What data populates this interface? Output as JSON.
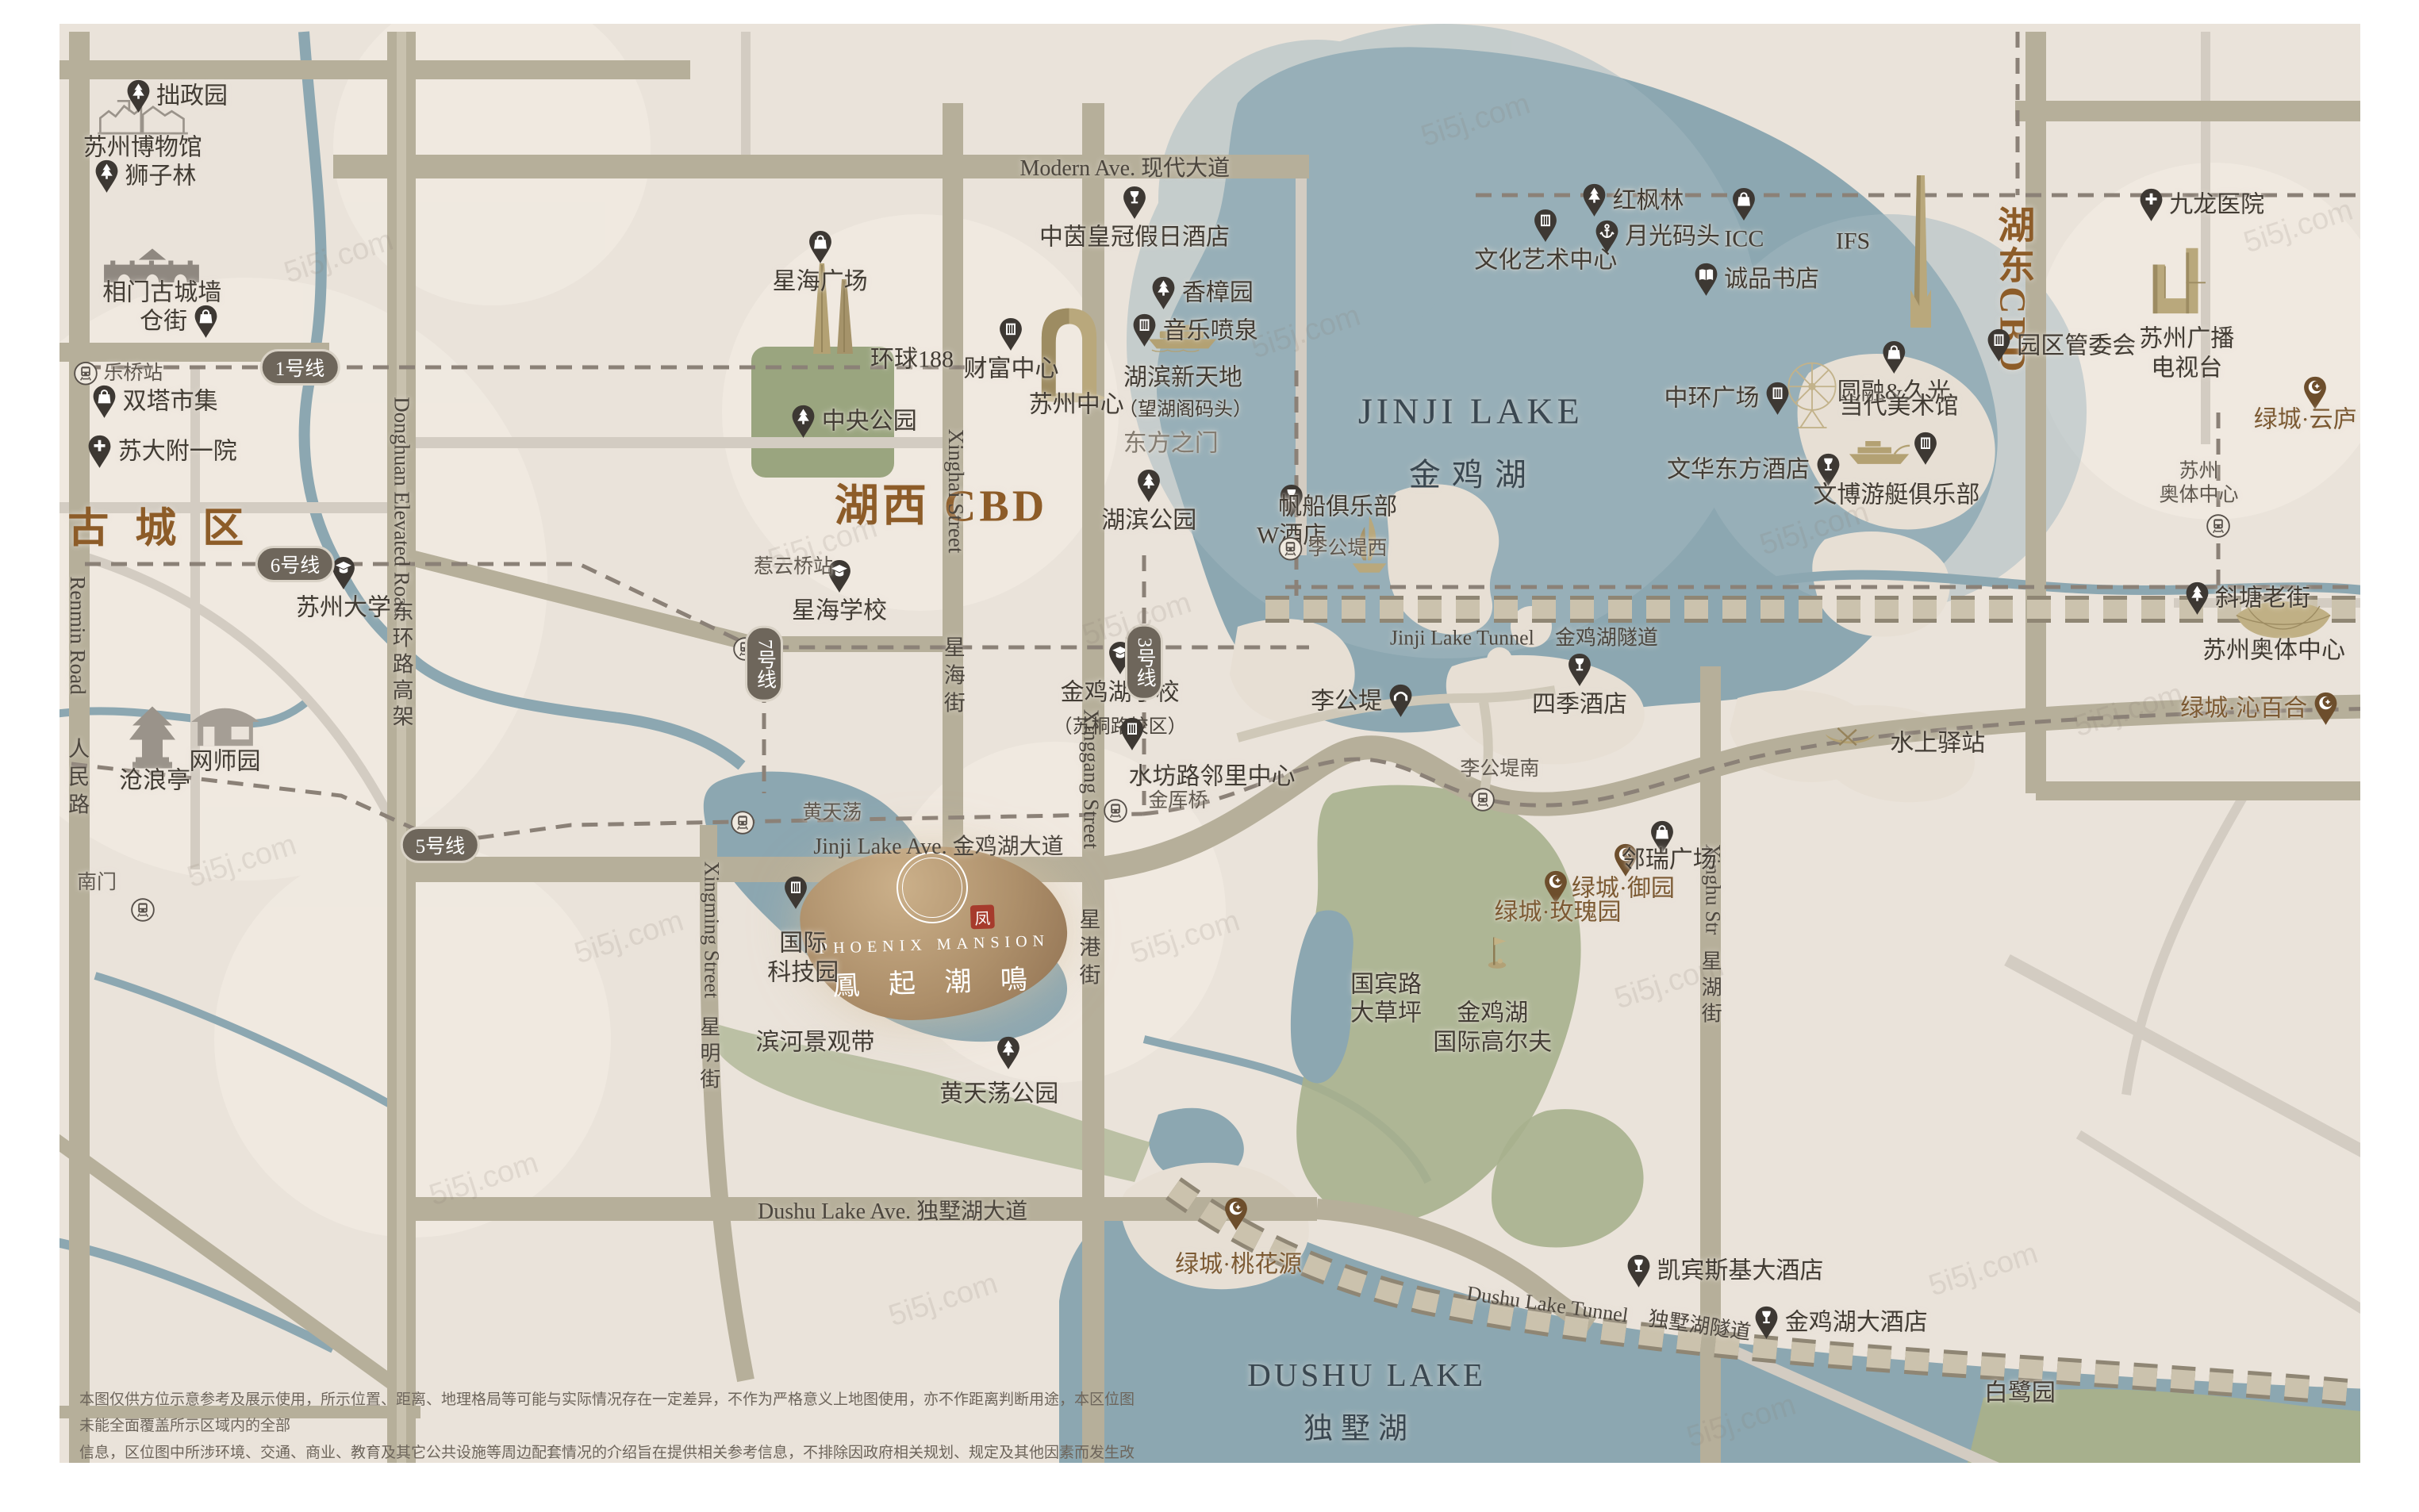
{
  "project": {
    "en": "PHOENIX MANSION",
    "zh": "鳳 起 潮 鳴",
    "seal": "凤",
    "x": 38.6,
    "y": 61.7
  },
  "colors": {
    "dark": "#423c34",
    "gray": "#847c71",
    "brown": "#8d5c28",
    "gt": "#7c5a33",
    "lake": "#3a4750",
    "road": "#4c463e"
  },
  "areas": [
    {
      "n": "old-town-label",
      "t": "古 城 区",
      "x": 6.6,
      "y": 34.7,
      "fs": 52,
      "c": "brown",
      "b": 1,
      "ls": 10
    },
    {
      "n": "huxi-cbd-label",
      "t": "湖西  CBD",
      "x": 38.9,
      "y": 33.2,
      "fs": 56,
      "c": "brown",
      "b": 1,
      "ls": 4
    },
    {
      "n": "hudong-cbd-label",
      "t": "湖东CBD",
      "x": 83.2,
      "y": 19.2,
      "fs": 47,
      "c": "brown",
      "b": 1,
      "v": 1,
      "ls": 4
    },
    {
      "n": "jinji-lake-name-en",
      "t": "JINJI LAKE",
      "x": 60.8,
      "y": 27.2,
      "fs": 46,
      "c": "lake",
      "ls": 5
    },
    {
      "n": "jinji-lake-name-zh",
      "t": "金鸡湖",
      "x": 60.9,
      "y": 31.2,
      "fs": 40,
      "c": "lake",
      "ls": 14
    },
    {
      "n": "dushu-lake-name-en",
      "t": "DUSHU LAKE",
      "x": 56.5,
      "y": 90.9,
      "fs": 41,
      "c": "lake",
      "ls": 4
    },
    {
      "n": "dushu-lake-name-zh",
      "t": "独墅湖",
      "x": 56.2,
      "y": 94.3,
      "fs": 37,
      "c": "lake",
      "ls": 10
    }
  ],
  "roads": [
    {
      "n": "modern-ave-label",
      "t": "Modern Ave. 现代大道",
      "x": 46.5,
      "y": 11.0,
      "fs": 28,
      "c": "road"
    },
    {
      "n": "jinji-lake-ave-label",
      "t": "Jinji Lake Ave. 金鸡湖大道",
      "x": 38.8,
      "y": 55.9,
      "fs": 28,
      "c": "road"
    },
    {
      "n": "dushu-lake-ave-label",
      "t": "Dushu Lake Ave. 独墅湖大道",
      "x": 36.9,
      "y": 80.0,
      "fs": 28,
      "c": "road"
    },
    {
      "n": "jinji-tunnel-label",
      "t": "Jinji Lake Tunnel　金鸡湖隧道",
      "x": 63.0,
      "y": 42.1,
      "fs": 26,
      "c": "road"
    },
    {
      "n": "dushu-tunnel-label",
      "t": "Dushu Lake Tunnel　独墅湖隧道",
      "x": 66.5,
      "y": 86.7,
      "fs": 26,
      "c": "road",
      "rot": 8
    },
    {
      "n": "renmin-road-en",
      "t": "Renmin Road",
      "x": 3.2,
      "y": 42.0,
      "fs": 27,
      "c": "road",
      "v": 1
    },
    {
      "n": "renmin-road-zh",
      "t": "人民路",
      "x": 3.2,
      "y": 51.5,
      "fs": 27,
      "c": "road",
      "v": 1,
      "ls": 8
    },
    {
      "n": "donghuan-road-en",
      "t": "Donghuan Elevated Road",
      "x": 16.6,
      "y": 33.5,
      "fs": 27,
      "c": "road",
      "v": 1
    },
    {
      "n": "donghuan-road-zh",
      "t": "东环路高架",
      "x": 16.6,
      "y": 44.0,
      "fs": 27,
      "c": "road",
      "v": 1,
      "ls": 6
    },
    {
      "n": "xinghai-street-en",
      "t": "Xinghai Street",
      "x": 39.5,
      "y": 32.5,
      "fs": 27,
      "c": "road",
      "v": 1
    },
    {
      "n": "xinghai-street-zh",
      "t": "星海街",
      "x": 39.4,
      "y": 44.8,
      "fs": 27,
      "c": "road",
      "v": 1,
      "ls": 8
    },
    {
      "n": "xinggang-street-en",
      "t": "Xinggang Street",
      "x": 45.1,
      "y": 51.5,
      "fs": 27,
      "c": "road",
      "v": 1
    },
    {
      "n": "xinggang-street-zh",
      "t": "星港街",
      "x": 45.0,
      "y": 62.8,
      "fs": 27,
      "c": "road",
      "v": 1,
      "ls": 8
    },
    {
      "n": "xingming-street-en",
      "t": "Xingming Street",
      "x": 29.4,
      "y": 61.5,
      "fs": 26,
      "c": "road",
      "v": 1
    },
    {
      "n": "xingming-street-zh",
      "t": "星明街",
      "x": 29.3,
      "y": 69.8,
      "fs": 26,
      "c": "road",
      "v": 1,
      "ls": 7
    },
    {
      "n": "xinghu-street-en",
      "t": "Xinghu Str",
      "x": 70.8,
      "y": 58.8,
      "fs": 26,
      "c": "road",
      "v": 1
    },
    {
      "n": "xinghu-street-zh",
      "t": "星湖街",
      "x": 70.7,
      "y": 65.4,
      "fs": 26,
      "c": "road",
      "v": 1,
      "ls": 7
    }
  ],
  "metro_badges": [
    {
      "n": "metro-line-1-badge",
      "t": "1号线",
      "x": 12.4,
      "y": 24.3
    },
    {
      "n": "metro-line-6-badge",
      "t": "6号线",
      "x": 12.2,
      "y": 37.3
    },
    {
      "n": "metro-line-5-badge",
      "t": "5号线",
      "x": 18.2,
      "y": 55.9
    },
    {
      "n": "metro-line-7-badge",
      "t": "7号线",
      "x": 31.6,
      "y": 43.9,
      "v": 1
    },
    {
      "n": "metro-line-3-badge",
      "t": "3号线",
      "x": 47.3,
      "y": 43.8,
      "v": 1
    }
  ],
  "landmarks": [
    {
      "n": "zhuozhengyuan",
      "t": "拙政园",
      "x": 7.3,
      "y": 6.4,
      "i": "tree",
      "l": "row"
    },
    {
      "n": "suzhou-museum",
      "t": "苏州博物馆",
      "x": 5.9,
      "y": 9.8,
      "l": "txt"
    },
    {
      "n": "shizilin",
      "t": "狮子林",
      "x": 6.0,
      "y": 11.7,
      "i": "tree",
      "l": "row"
    },
    {
      "n": "xiangmen-wall",
      "t": "相门古城墙",
      "x": 6.7,
      "y": 19.4,
      "l": "txt"
    },
    {
      "n": "cangjie",
      "t": "仓街",
      "x": 7.4,
      "y": 21.3,
      "i": "bag",
      "l": "rr"
    },
    {
      "n": "leqiao-station",
      "t": "乐桥站",
      "x": 4.9,
      "y": 24.7,
      "i": "station",
      "l": "row",
      "cls": "st"
    },
    {
      "n": "shuangta-market",
      "t": "双塔市集",
      "x": 6.4,
      "y": 26.6,
      "i": "bag",
      "l": "row"
    },
    {
      "n": "suda-fuyi-hospital",
      "t": "苏大附一院",
      "x": 6.7,
      "y": 29.9,
      "i": "cross",
      "l": "row"
    },
    {
      "n": "suzhou-university",
      "t": "苏州大学",
      "x": 14.2,
      "y": 39.0,
      "i": "grad",
      "l": "col"
    },
    {
      "n": "wangshiyuan",
      "t": "网师园",
      "x": 9.3,
      "y": 50.4,
      "l": "txt"
    },
    {
      "n": "canglangting",
      "t": "沧浪亭",
      "x": 6.4,
      "y": 51.7,
      "l": "txt"
    },
    {
      "n": "nanmen",
      "t": "南门",
      "x": 4.0,
      "y": 58.4,
      "l": "txt",
      "cls": "st"
    },
    {
      "n": "nanmen-station-icon",
      "x": 5.9,
      "y": 60.2,
      "i": "station",
      "l": "row"
    },
    {
      "n": "xinghai-plaza",
      "t": "星海广场",
      "x": 33.9,
      "y": 17.4,
      "i": "bag",
      "l": "col"
    },
    {
      "n": "global-188",
      "t": "环球188",
      "x": 37.7,
      "y": 23.8,
      "l": "txt"
    },
    {
      "n": "central-park",
      "t": "中央公园",
      "x": 35.3,
      "y": 27.9,
      "i": "tree",
      "l": "row"
    },
    {
      "n": "fortune-center",
      "t": "财富中心",
      "x": 41.8,
      "y": 23.2,
      "i": "building",
      "l": "col"
    },
    {
      "n": "crowne-plaza-hotel",
      "t": "中茵皇冠假日酒店",
      "x": 46.9,
      "y": 14.5,
      "i": "wine",
      "l": "col"
    },
    {
      "n": "xiangzhangyuan",
      "t": "香樟园",
      "x": 49.7,
      "y": 19.4,
      "i": "tree",
      "l": "row"
    },
    {
      "n": "music-fountain",
      "t": "音乐喷泉",
      "x": 49.4,
      "y": 21.9,
      "i": "building",
      "l": "row"
    },
    {
      "n": "hubin-xintiandi",
      "t": "湖滨新天地",
      "x": 48.9,
      "y": 25.0,
      "l": "txt"
    },
    {
      "n": "wanghuge-wharf",
      "t": "（望湖阁码头）",
      "x": 49.0,
      "y": 27.1,
      "l": "txt",
      "fs": 24
    },
    {
      "n": "oriental-gate-label",
      "t": "东方之门",
      "x": 48.4,
      "y": 29.4,
      "l": "txt",
      "c": "gray"
    },
    {
      "n": "suzhou-center-label",
      "t": "苏州中心",
      "x": 44.5,
      "y": 26.8,
      "l": "txt"
    },
    {
      "n": "xinghai-school",
      "t": "星海学校",
      "x": 34.7,
      "y": 39.2,
      "i": "grad",
      "l": "col"
    },
    {
      "n": "hubin-park",
      "t": "湖滨公园",
      "x": 47.5,
      "y": 33.2,
      "i": "tree",
      "l": "col"
    },
    {
      "n": "w-hotel",
      "t": "W酒店",
      "x": 53.4,
      "y": 34.2,
      "i": "wine",
      "l": "col"
    },
    {
      "n": "sailing-club",
      "t": "帆船俱乐部",
      "x": 55.3,
      "y": 33.6,
      "l": "txt"
    },
    {
      "n": "ligongdi-west-station",
      "t": "李公堤西",
      "x": 55.1,
      "y": 36.3,
      "i": "station",
      "l": "row",
      "cls": "st"
    },
    {
      "n": "reyunqiao-station",
      "t": "惹云桥站",
      "x": 32.8,
      "y": 37.5,
      "l": "txt",
      "cls": "st"
    },
    {
      "n": "reyunqiao-station-icon",
      "x": 30.8,
      "y": 42.9,
      "i": "station",
      "l": "row"
    },
    {
      "n": "jinjihu-school",
      "t": "金鸡湖学校",
      "x": 46.3,
      "y": 45.6,
      "i": "grad",
      "l": "col",
      "sub": "（苏桐路校区）"
    },
    {
      "n": "shuifanglu-center-pin",
      "x": 46.8,
      "y": 48.6,
      "i": "building",
      "l": "row"
    },
    {
      "n": "shuifanglu-center",
      "t": "水坊路邻里中心",
      "x": 50.1,
      "y": 51.4,
      "l": "txt"
    },
    {
      "n": "jinshe-bridge",
      "t": "金厍桥",
      "x": 48.7,
      "y": 53.0,
      "l": "txt",
      "cls": "st"
    },
    {
      "n": "jinshe-bridge-icon",
      "x": 46.1,
      "y": 53.6,
      "i": "station",
      "l": "row"
    },
    {
      "n": "huangtiandang",
      "t": "黄天荡",
      "x": 34.4,
      "y": 53.8,
      "l": "txt",
      "cls": "st"
    },
    {
      "n": "huangtiandang-icon",
      "x": 30.7,
      "y": 54.4,
      "i": "station",
      "l": "row"
    },
    {
      "n": "intl-tech-park-pin",
      "x": 32.9,
      "y": 59.1,
      "i": "building",
      "l": "row"
    },
    {
      "n": "intl-tech-park",
      "t": [
        "国际",
        "科技园"
      ],
      "x": 33.2,
      "y": 63.4,
      "l": "txt"
    },
    {
      "n": "binhe-landscape-belt",
      "t": "滨河景观带",
      "x": 33.7,
      "y": 69.0,
      "l": "txt"
    },
    {
      "n": "huangtiandang-park-pin",
      "x": 41.7,
      "y": 69.7,
      "i": "tree",
      "l": "row"
    },
    {
      "n": "huangtiandang-park",
      "t": "黄天荡公园",
      "x": 41.3,
      "y": 72.4,
      "l": "txt"
    },
    {
      "n": "guobin-road-lawn",
      "t": [
        "国宾路",
        "大草坪"
      ],
      "x": 57.3,
      "y": 66.1,
      "l": "txt"
    },
    {
      "n": "golf-flag-icon",
      "x": 61.9,
      "y": 62.9,
      "i": "golf",
      "l": "row"
    },
    {
      "n": "jinji-intl-golf",
      "t": [
        "金鸡湖",
        "国际高尔夫"
      ],
      "x": 61.7,
      "y": 68.0,
      "l": "txt"
    },
    {
      "n": "rose-garden-pin",
      "x": 64.3,
      "y": 58.7,
      "i": "gt",
      "l": "row"
    },
    {
      "n": "greentown-rose-garden",
      "t": "绿城·玫瑰园",
      "x": 64.4,
      "y": 60.4,
      "l": "txt",
      "c": "gt"
    },
    {
      "n": "yu-garden-pin",
      "x": 67.2,
      "y": 56.9,
      "i": "gt",
      "l": "row"
    },
    {
      "n": "greentown-yu-garden",
      "t": "绿城·御园",
      "x": 67.1,
      "y": 58.8,
      "l": "txt",
      "c": "gt"
    },
    {
      "n": "linrui-plaza-pin",
      "x": 68.7,
      "y": 55.4,
      "i": "bag",
      "l": "row"
    },
    {
      "n": "linrui-plaza",
      "t": "邻瑞广场",
      "x": 69.0,
      "y": 56.9,
      "l": "txt"
    },
    {
      "n": "taohuayuan-pin",
      "x": 51.1,
      "y": 80.3,
      "i": "gt",
      "l": "row"
    },
    {
      "n": "greentown-taohuayuan",
      "t": "绿城·桃花源",
      "x": 51.2,
      "y": 83.7,
      "l": "txt",
      "c": "gt"
    },
    {
      "n": "kempinski-hotel",
      "t": "凯宾斯基大酒店",
      "x": 71.3,
      "y": 84.1,
      "i": "wine",
      "l": "row"
    },
    {
      "n": "jinjihu-grand-hotel",
      "t": "金鸡湖大酒店",
      "x": 76.1,
      "y": 87.5,
      "i": "wine",
      "l": "row"
    },
    {
      "n": "bailuyuan",
      "t": "白鹭园",
      "x": 83.5,
      "y": 92.2,
      "l": "txt"
    },
    {
      "n": "hongfenglin",
      "t": "红枫林",
      "x": 67.5,
      "y": 13.3,
      "i": "tree",
      "l": "row"
    },
    {
      "n": "icc",
      "t": "ICC",
      "x": 72.1,
      "y": 14.6,
      "i": "bag",
      "l": "col"
    },
    {
      "n": "culture-art-center",
      "t": "文化艺术中心",
      "x": 63.9,
      "y": 16.0,
      "i": "building",
      "l": "col"
    },
    {
      "n": "moonlight-wharf",
      "t": "月光码头",
      "x": 68.5,
      "y": 15.7,
      "i": "anchor",
      "l": "row"
    },
    {
      "n": "eslite-bookstore",
      "t": "诚品书店",
      "x": 72.6,
      "y": 18.5,
      "i": "book",
      "l": "row"
    },
    {
      "n": "ifs-label",
      "t": "IFS",
      "x": 76.6,
      "y": 16.0,
      "l": "txt"
    },
    {
      "n": "yuanrong-jiuguang",
      "t": "圆融&久光",
      "x": 78.3,
      "y": 24.7,
      "i": "bag",
      "l": "col"
    },
    {
      "n": "zhonghuan-plaza",
      "t": "中环广场",
      "x": 71.4,
      "y": 26.4,
      "i": "building",
      "l": "rr"
    },
    {
      "n": "moca-museum",
      "t": "当代美术馆",
      "x": 78.5,
      "y": 26.9,
      "l": "txt"
    },
    {
      "n": "moca-museum-pin",
      "x": 79.6,
      "y": 29.7,
      "i": "building",
      "l": "row"
    },
    {
      "n": "mandarin-oriental-hotel",
      "t": "文华东方酒店",
      "x": 72.5,
      "y": 31.1,
      "i": "wine",
      "l": "rr"
    },
    {
      "n": "wenbo-yacht-club",
      "t": "文博游艇俱乐部",
      "x": 78.4,
      "y": 32.8,
      "l": "txt"
    },
    {
      "n": "sipac-admin-committee",
      "t": "园区管委会",
      "x": 85.2,
      "y": 22.9,
      "i": "building",
      "l": "row"
    },
    {
      "n": "jiulong-hospital",
      "t": "九龙医院",
      "x": 91.0,
      "y": 13.6,
      "i": "cross",
      "l": "row"
    },
    {
      "n": "suzhou-broadcasting",
      "t": [
        "苏州广播",
        "电视台"
      ],
      "x": 90.4,
      "y": 23.4,
      "l": "txt"
    },
    {
      "n": "yunlu-pin",
      "x": 95.7,
      "y": 26.0,
      "i": "gt",
      "l": "row"
    },
    {
      "n": "greentown-yunlu",
      "t": "绿城·云庐",
      "x": 95.3,
      "y": 27.8,
      "l": "txt",
      "c": "gt"
    },
    {
      "n": "aoti-station",
      "t": [
        "苏州",
        "奥体中心"
      ],
      "x": 90.9,
      "y": 32.0,
      "l": "txt",
      "cls": "st"
    },
    {
      "n": "aoti-station-icon",
      "x": 91.7,
      "y": 34.8,
      "i": "station",
      "l": "row"
    },
    {
      "n": "xietang-old-street",
      "t": "斜塘老街",
      "x": 92.9,
      "y": 39.6,
      "i": "tree",
      "l": "row"
    },
    {
      "n": "suzhou-olympic-center",
      "t": "苏州奥体中心",
      "x": 94.0,
      "y": 43.1,
      "l": "txt"
    },
    {
      "n": "greentown-qinbaihe",
      "t": "绿城·沁百合",
      "x": 93.4,
      "y": 46.9,
      "i": "gt",
      "l": "rr",
      "c": "gt"
    },
    {
      "n": "shuishang-post",
      "t": "水上驿站",
      "x": 80.1,
      "y": 49.2,
      "l": "txt"
    },
    {
      "n": "ligongdi",
      "t": "李公堤",
      "x": 56.3,
      "y": 46.4,
      "i": "bridge",
      "l": "rr"
    },
    {
      "n": "four-seasons-hotel",
      "t": "四季酒店",
      "x": 65.3,
      "y": 45.4,
      "i": "wine",
      "l": "col"
    },
    {
      "n": "ligongdi-south",
      "t": "李公堤南",
      "x": 62.0,
      "y": 50.9,
      "l": "txt",
      "cls": "st"
    },
    {
      "n": "ligongdi-south-icon",
      "x": 61.3,
      "y": 52.9,
      "i": "station",
      "l": "row"
    }
  ],
  "illustrations": [
    {
      "n": "suzhou-museum-illustration",
      "i": "museum",
      "x": 5.9,
      "y": 7.7,
      "w": 118
    },
    {
      "n": "citywall-illustration",
      "i": "wall",
      "x": 6.3,
      "y": 17.2,
      "w": 132
    },
    {
      "n": "pavilion-illustration",
      "i": "pavilion",
      "x": 6.3,
      "y": 49.0,
      "w": 70
    },
    {
      "n": "garden-house-illustration",
      "i": "house",
      "x": 9.3,
      "y": 48.1,
      "w": 96
    },
    {
      "n": "towers188-illustration",
      "i": "towers",
      "x": 34.5,
      "y": 20.4,
      "w": 70
    },
    {
      "n": "oriental-gate-illustration",
      "i": "gate",
      "x": 44.2,
      "y": 23.3,
      "w": 94
    },
    {
      "n": "ferry-illustration",
      "i": "ferry",
      "x": 48.9,
      "y": 22.3,
      "w": 94
    },
    {
      "n": "sailboat-illustration",
      "i": "sailboat",
      "x": 56.6,
      "y": 36.2,
      "w": 58
    },
    {
      "n": "yacht-illustration",
      "i": "yacht",
      "x": 77.7,
      "y": 30.0,
      "w": 82
    },
    {
      "n": "canoe-illustration",
      "i": "canoe",
      "x": 76.5,
      "y": 49.0,
      "w": 70
    },
    {
      "n": "ferris-wheel-illustration",
      "i": "ferris",
      "x": 74.9,
      "y": 26.2,
      "w": 74
    },
    {
      "n": "ifs-tower-illustration",
      "i": "ifs",
      "x": 79.4,
      "y": 16.8,
      "w": 42
    },
    {
      "n": "tv-tower-illustration",
      "i": "tvtower",
      "x": 90.3,
      "y": 18.6,
      "w": 90
    },
    {
      "n": "stadium-illustration",
      "i": "stadium",
      "x": 94.4,
      "y": 41.0,
      "w": 130
    }
  ],
  "watermark": {
    "text": "5i5j.com",
    "spots": [
      [
        14,
        17
      ],
      [
        34,
        36
      ],
      [
        54,
        22
      ],
      [
        75,
        35
      ],
      [
        26,
        62
      ],
      [
        49,
        62
      ],
      [
        69,
        65
      ],
      [
        88,
        47
      ],
      [
        39,
        86
      ],
      [
        82,
        84
      ],
      [
        20,
        78
      ],
      [
        95,
        15
      ],
      [
        10,
        57
      ],
      [
        61,
        8
      ],
      [
        72,
        94
      ],
      [
        47,
        41
      ]
    ]
  },
  "disclaimer": {
    "l1": "本图仅供方位示意参考及展示使用，所示位置、距离、地理格局等可能与实际情况存在一定差异，不作为严格意义上地图使用，亦不作距离判断用途，本区位图未能全面覆盖所示区域内的全部",
    "l2": "信息，区位图中所涉环境、交通、商业、教育及其它公共设施等周边配套情况的介绍旨在提供相关参考信息，不排除因政府相关规划、规定及其他因素而发生改变，请自行前往相关部门、单位",
    "l3": "查询了解。本图制作日期为【2025】年【5】月【30】日。"
  }
}
